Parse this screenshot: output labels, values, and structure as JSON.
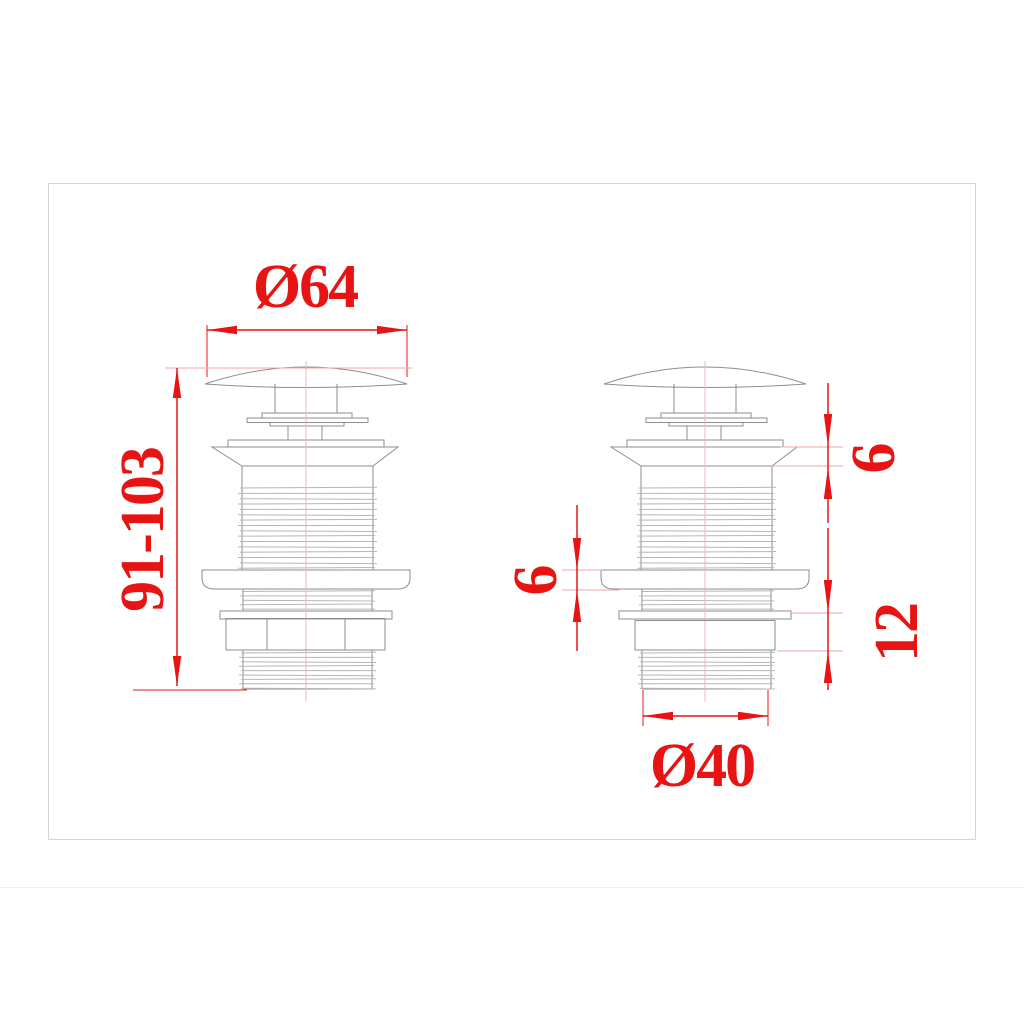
{
  "drawing": {
    "subject": "basin pop-up drain waste, two side views",
    "dimensions": {
      "cap_diameter": "Ø64",
      "installation_height": "91-103",
      "flange_height": "6",
      "seal_height": "6",
      "nut_height": "12",
      "thread_diameter": "Ø40"
    },
    "colors": {
      "dimension_red": "#e81414",
      "extension_pink": "#f2a5a5",
      "outline_gray": "#8e8e8e",
      "thread_gray": "#b6b6b6",
      "frame_border": "#d4d4d4"
    }
  }
}
